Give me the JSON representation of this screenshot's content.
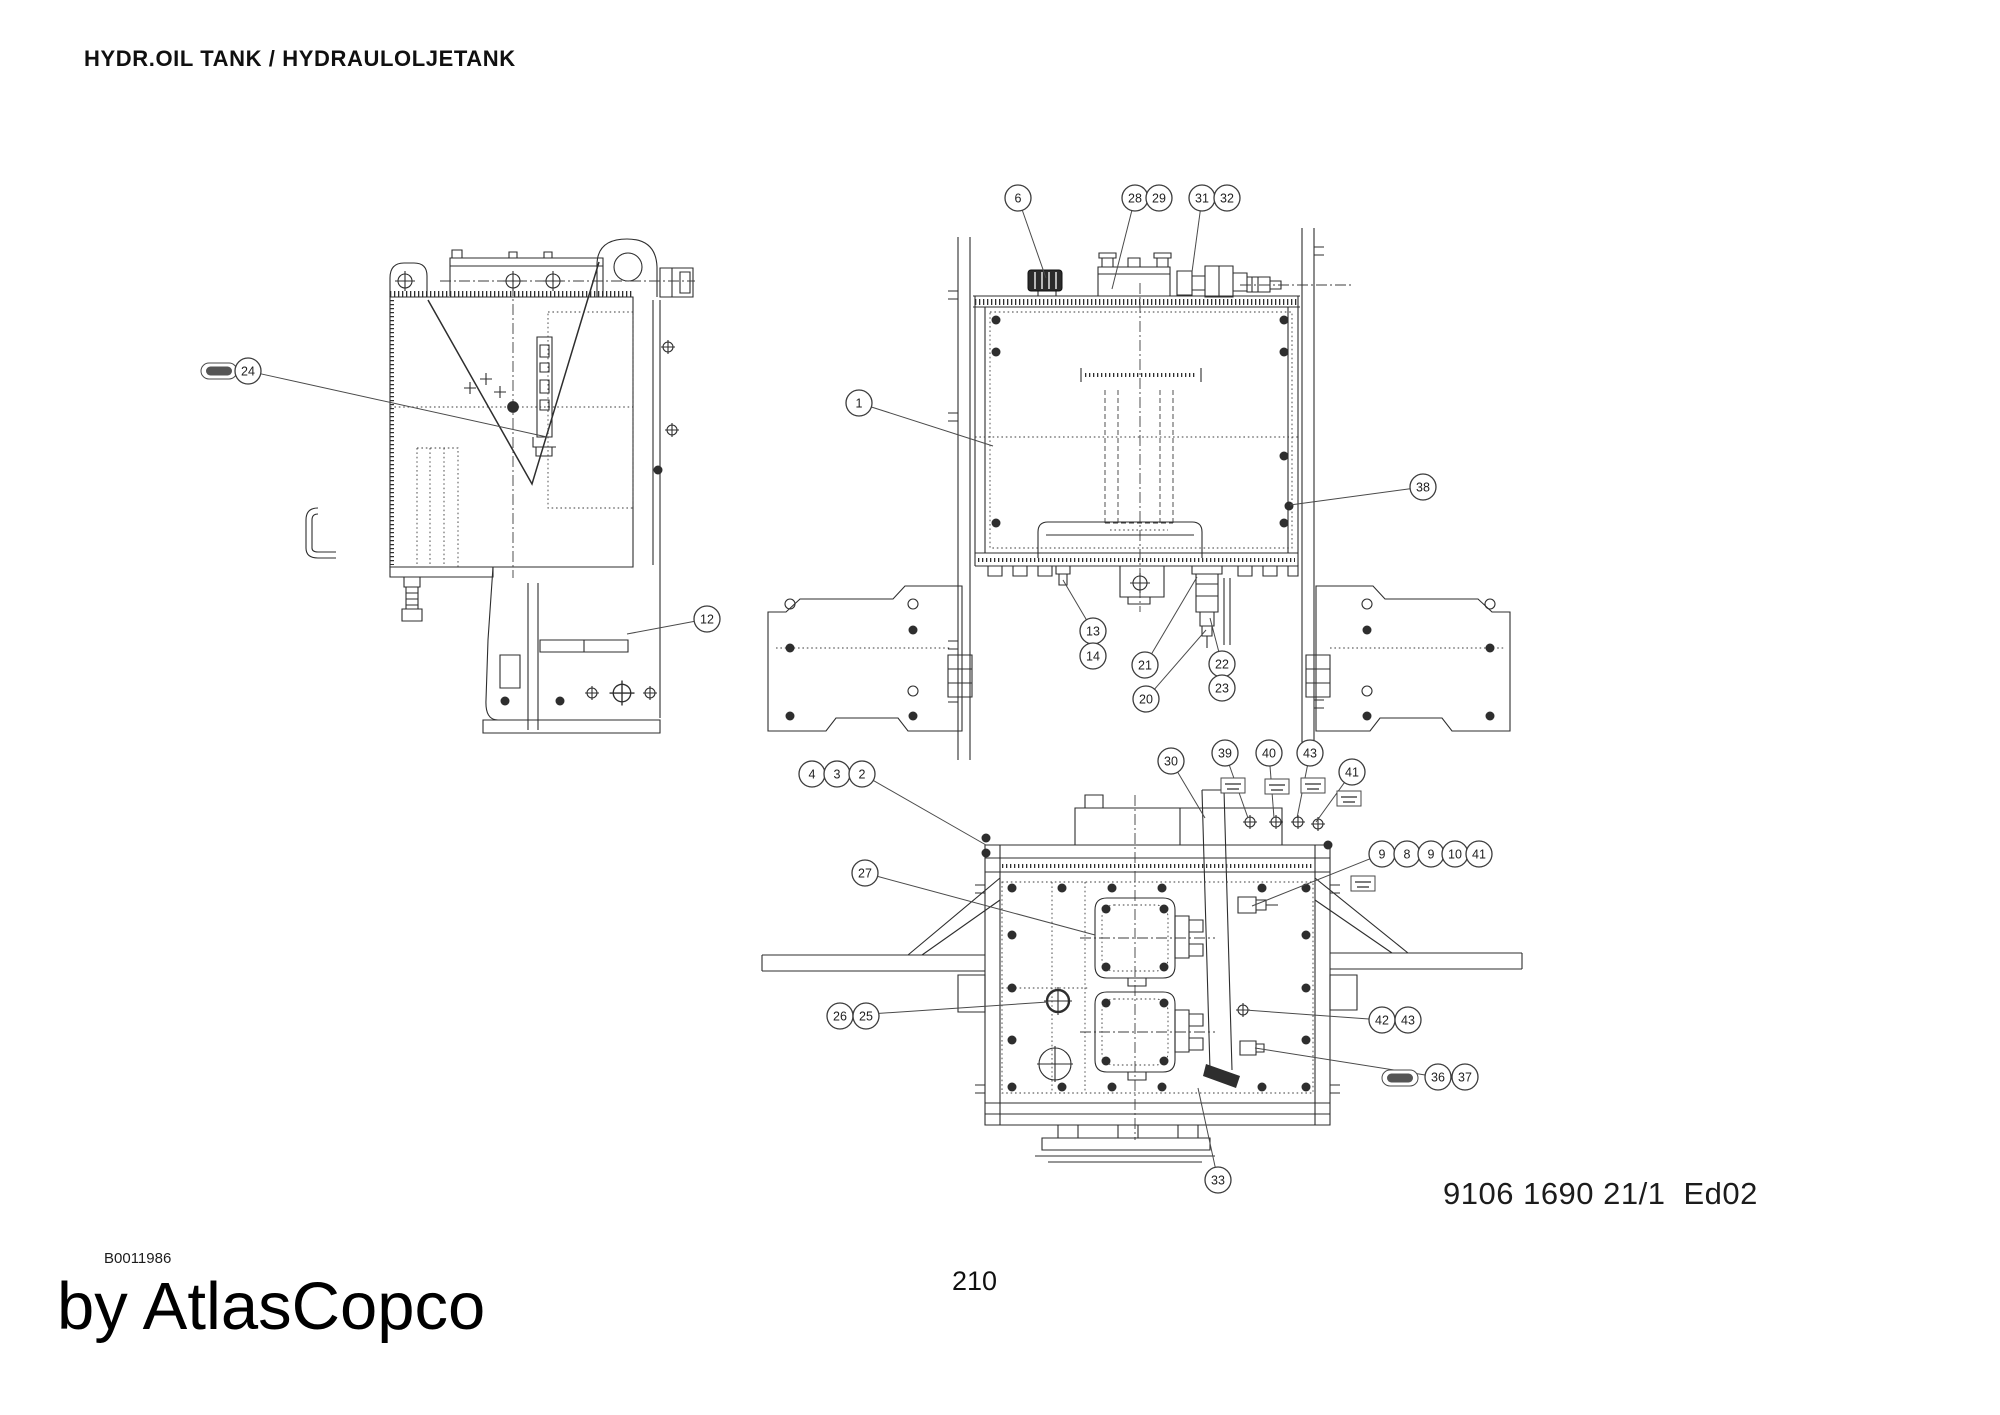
{
  "page": {
    "title": "HYDR.OIL TANK / HYDRAULOLJETANK",
    "doc_number": "9106 1690 21/1",
    "edition": "Ed02",
    "figure_code": "B0011986",
    "brand_signature": "by AtlasCopco",
    "page_number": "210"
  },
  "callouts": [
    {
      "n": "24",
      "x": 248,
      "y": 371,
      "t": [
        547,
        437
      ],
      "pill": [
        219,
        371
      ]
    },
    {
      "n": "12",
      "x": 707,
      "y": 619,
      "t": [
        627,
        634
      ]
    },
    {
      "n": "6",
      "x": 1018,
      "y": 198,
      "t": [
        1046,
        278
      ]
    },
    {
      "n": "28",
      "x": 1135,
      "y": 198,
      "t": [
        1112,
        289
      ]
    },
    {
      "n": "29",
      "x": 1159,
      "y": 198
    },
    {
      "n": "31",
      "x": 1202,
      "y": 198,
      "t": [
        1192,
        272
      ]
    },
    {
      "n": "32",
      "x": 1227,
      "y": 198
    },
    {
      "n": "1",
      "x": 859,
      "y": 403,
      "t": [
        993,
        446
      ]
    },
    {
      "n": "38",
      "x": 1423,
      "y": 487,
      "t": [
        1290,
        505
      ]
    },
    {
      "n": "13",
      "x": 1093,
      "y": 631,
      "t": [
        1063,
        580
      ]
    },
    {
      "n": "14",
      "x": 1093,
      "y": 656
    },
    {
      "n": "21",
      "x": 1145,
      "y": 665,
      "t": [
        1197,
        577
      ]
    },
    {
      "n": "20",
      "x": 1146,
      "y": 699,
      "t": [
        1206,
        630
      ]
    },
    {
      "n": "22",
      "x": 1222,
      "y": 664,
      "t": [
        1210,
        618
      ]
    },
    {
      "n": "23",
      "x": 1222,
      "y": 688
    },
    {
      "n": "4",
      "x": 812,
      "y": 774
    },
    {
      "n": "3",
      "x": 837,
      "y": 774
    },
    {
      "n": "2",
      "x": 862,
      "y": 774,
      "t": [
        986,
        845
      ]
    },
    {
      "n": "27",
      "x": 865,
      "y": 873,
      "t": [
        1095,
        935
      ]
    },
    {
      "n": "30",
      "x": 1171,
      "y": 761,
      "t": [
        1205,
        818
      ]
    },
    {
      "n": "39",
      "x": 1225,
      "y": 753,
      "t": [
        1248,
        818
      ],
      "flag": [
        1233,
        786
      ]
    },
    {
      "n": "40",
      "x": 1269,
      "y": 753,
      "t": [
        1274,
        818
      ],
      "flag": [
        1277,
        787
      ]
    },
    {
      "n": "43",
      "x": 1310,
      "y": 753,
      "t": [
        1297,
        818
      ],
      "flag": [
        1313,
        786
      ]
    },
    {
      "n": "41",
      "x": 1352,
      "y": 772,
      "t": [
        1316,
        822
      ],
      "flag": [
        1349,
        799
      ]
    },
    {
      "n": "9",
      "x": 1382,
      "y": 854,
      "t": [
        1252,
        906
      ],
      "flag": [
        1363,
        884
      ]
    },
    {
      "n": "8",
      "x": 1407,
      "y": 854
    },
    {
      "n": "9",
      "x": 1431,
      "y": 854
    },
    {
      "n": "10",
      "x": 1455,
      "y": 854
    },
    {
      "n": "41",
      "x": 1479,
      "y": 854
    },
    {
      "n": "26",
      "x": 840,
      "y": 1016,
      "t": [
        1048,
        1002
      ]
    },
    {
      "n": "25",
      "x": 866,
      "y": 1016
    },
    {
      "n": "42",
      "x": 1382,
      "y": 1020,
      "t": [
        1245,
        1010
      ]
    },
    {
      "n": "43",
      "x": 1408,
      "y": 1020
    },
    {
      "n": "36",
      "x": 1438,
      "y": 1077,
      "t": [
        1255,
        1048
      ],
      "pill": [
        1400,
        1078
      ]
    },
    {
      "n": "37",
      "x": 1465,
      "y": 1077
    },
    {
      "n": "33",
      "x": 1218,
      "y": 1180,
      "t": [
        1198,
        1088
      ]
    }
  ]
}
